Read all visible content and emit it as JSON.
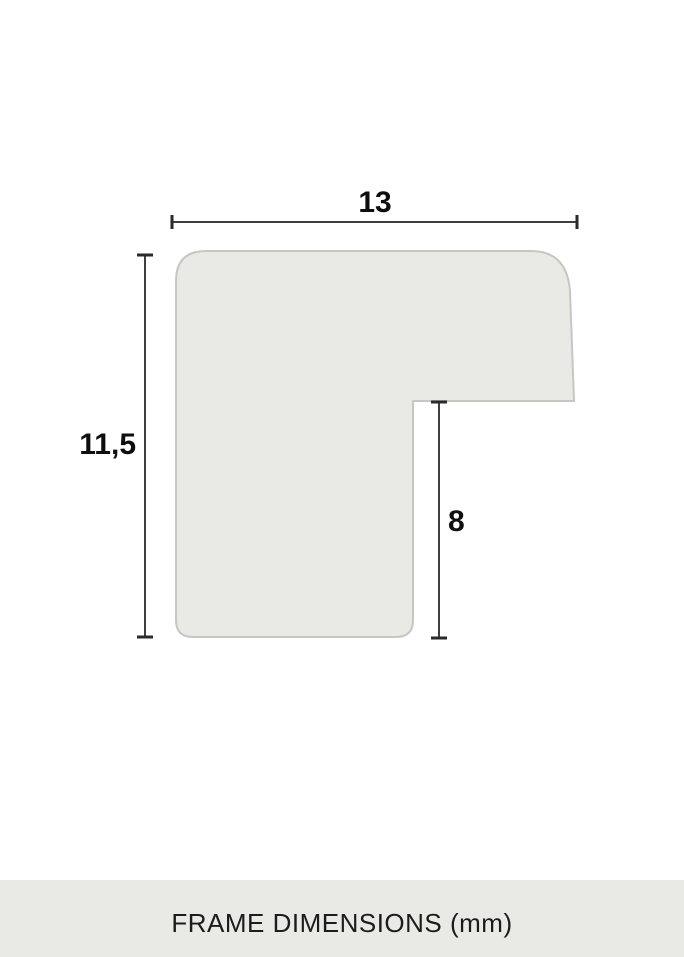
{
  "diagram": {
    "title": "frame-profile-cross-section",
    "width_label": "13",
    "height_label": "11,5",
    "notch_label": "8",
    "unit": "mm",
    "shape_fill": "#e9e9e5",
    "shape_stroke": "#c7c7c2",
    "dimension_line_color": "#3f3f3f",
    "label_color": "#0e0e0e"
  },
  "footer": {
    "label": "FRAME DIMENSIONS (mm)",
    "background": "#e9e9e5",
    "text_color": "#1c1c1a"
  }
}
